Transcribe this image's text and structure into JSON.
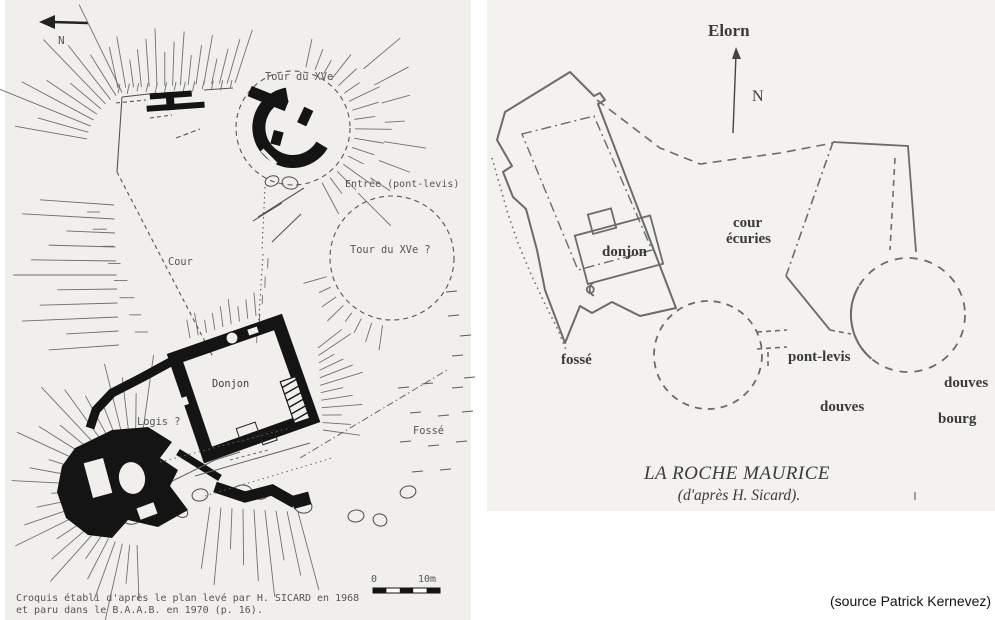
{
  "page": {
    "background": "#ffffff"
  },
  "left_plan": {
    "north_label": "N",
    "labels": {
      "tour_xve": "Tour du XVe",
      "entree": "Entrée (pont-levis)",
      "tour_xve_q": "Tour du XVe ?",
      "cour": "Cour",
      "donjon": "Donjon",
      "logis": "Logis ?",
      "fosse": "Fossé"
    },
    "scale": {
      "zero": "0",
      "ten": "10m"
    },
    "caption_line1": "Croquis établi d'après le plan levé par H. SICARD en 1968",
    "caption_line2": "et paru dans le B.A.A.B. en 1970 (p. 16)."
  },
  "right_plan": {
    "river_label": "Elorn",
    "north_label": "N",
    "labels": {
      "donjon": "donjon",
      "cour_line1": "cour",
      "cour_line2": "écuries",
      "fosse": "fossé",
      "pont_levis": "pont-levis",
      "douves": "douves",
      "douves_bourg_line1": "douves",
      "douves_bourg_line2": "bourg"
    },
    "title": "LA ROCHE MAURICE",
    "subtitle": "(d'après H. Sicard)."
  },
  "source_credit": "(source Patrick Kernevez)"
}
